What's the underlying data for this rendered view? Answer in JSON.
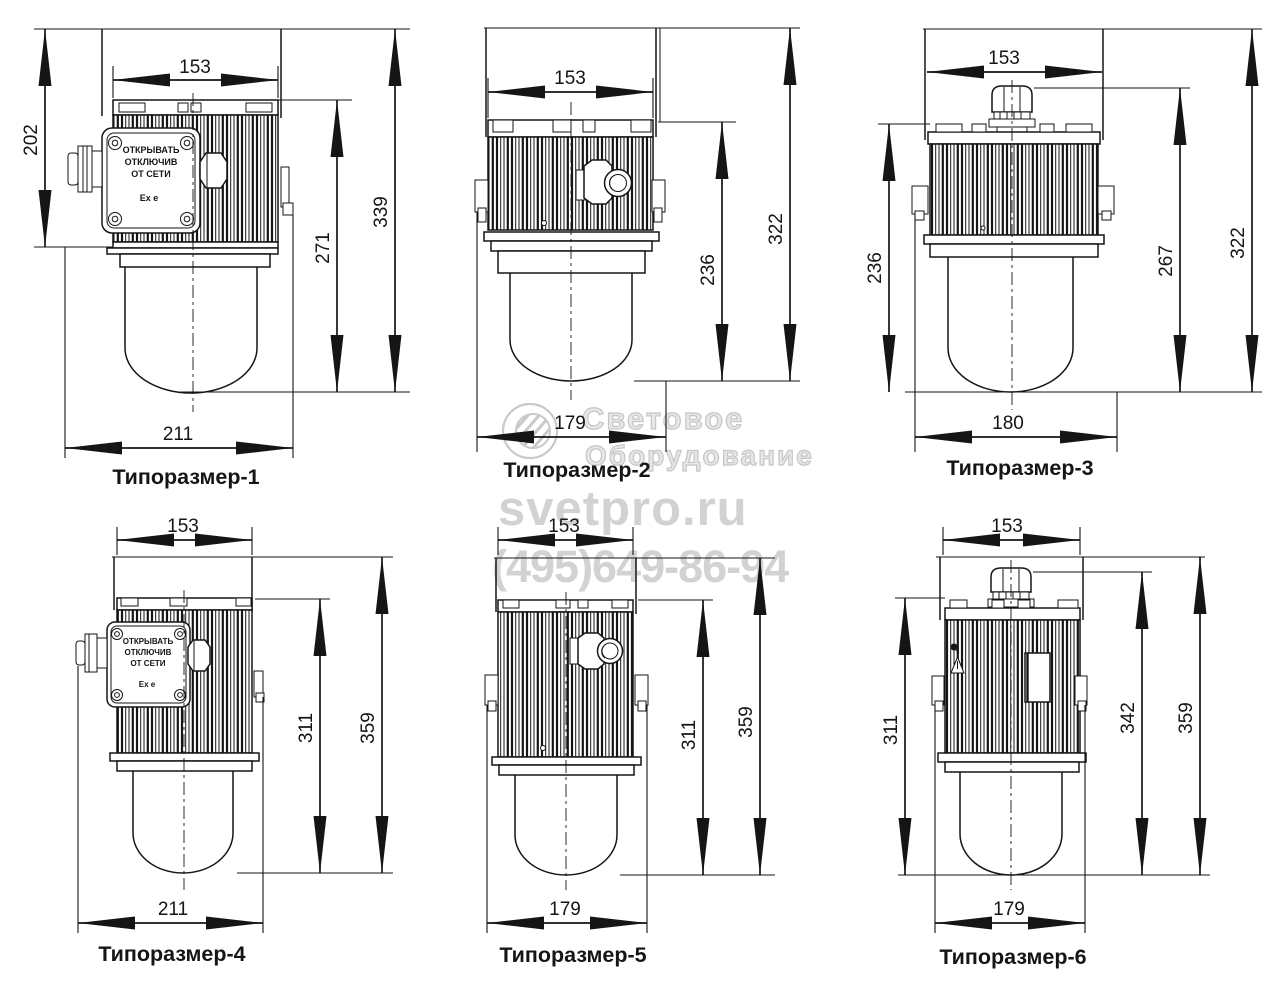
{
  "watermark": {
    "brand_line1": "Световое",
    "brand_line2": "Оборудование",
    "site": "svetpro.ru",
    "phone": "(495)649-86-94"
  },
  "colors": {
    "line": "#151515",
    "watermark_gray": "#d2d2d2"
  },
  "figures": [
    {
      "caption": "Типоразмер-1",
      "dims": {
        "top": "153",
        "left": "202",
        "inner": "271",
        "outer": "339",
        "bottom": "211"
      },
      "box": {
        "line1": "ОТКРЫВАТЬ",
        "line2": "ОТКЛЮЧИВ",
        "line3": "ОТ СЕТИ",
        "marking": "Ex e"
      }
    },
    {
      "caption": "Типоразмер-2",
      "dims": {
        "top": "153",
        "inner": "236",
        "outer": "322",
        "bottom": "179"
      }
    },
    {
      "caption": "Типоразмер-3",
      "dims": {
        "top": "153",
        "left": "236",
        "inner": "267",
        "outer": "322",
        "bottom": "180"
      }
    },
    {
      "caption": "Типоразмер-4",
      "dims": {
        "top": "153",
        "inner": "311",
        "outer": "359",
        "bottom": "211"
      },
      "box": {
        "line1": "ОТКРЫВАТЬ",
        "line2": "ОТКЛЮЧИВ",
        "line3": "ОТ СЕТИ",
        "marking": "Ex e"
      }
    },
    {
      "caption": "Типоразмер-5",
      "dims": {
        "top": "153",
        "inner": "311",
        "outer": "359",
        "bottom": "179"
      }
    },
    {
      "caption": "Типоразмер-6",
      "dims": {
        "top": "153",
        "left": "311",
        "inner": "342",
        "outer": "359",
        "bottom": "179"
      }
    }
  ]
}
